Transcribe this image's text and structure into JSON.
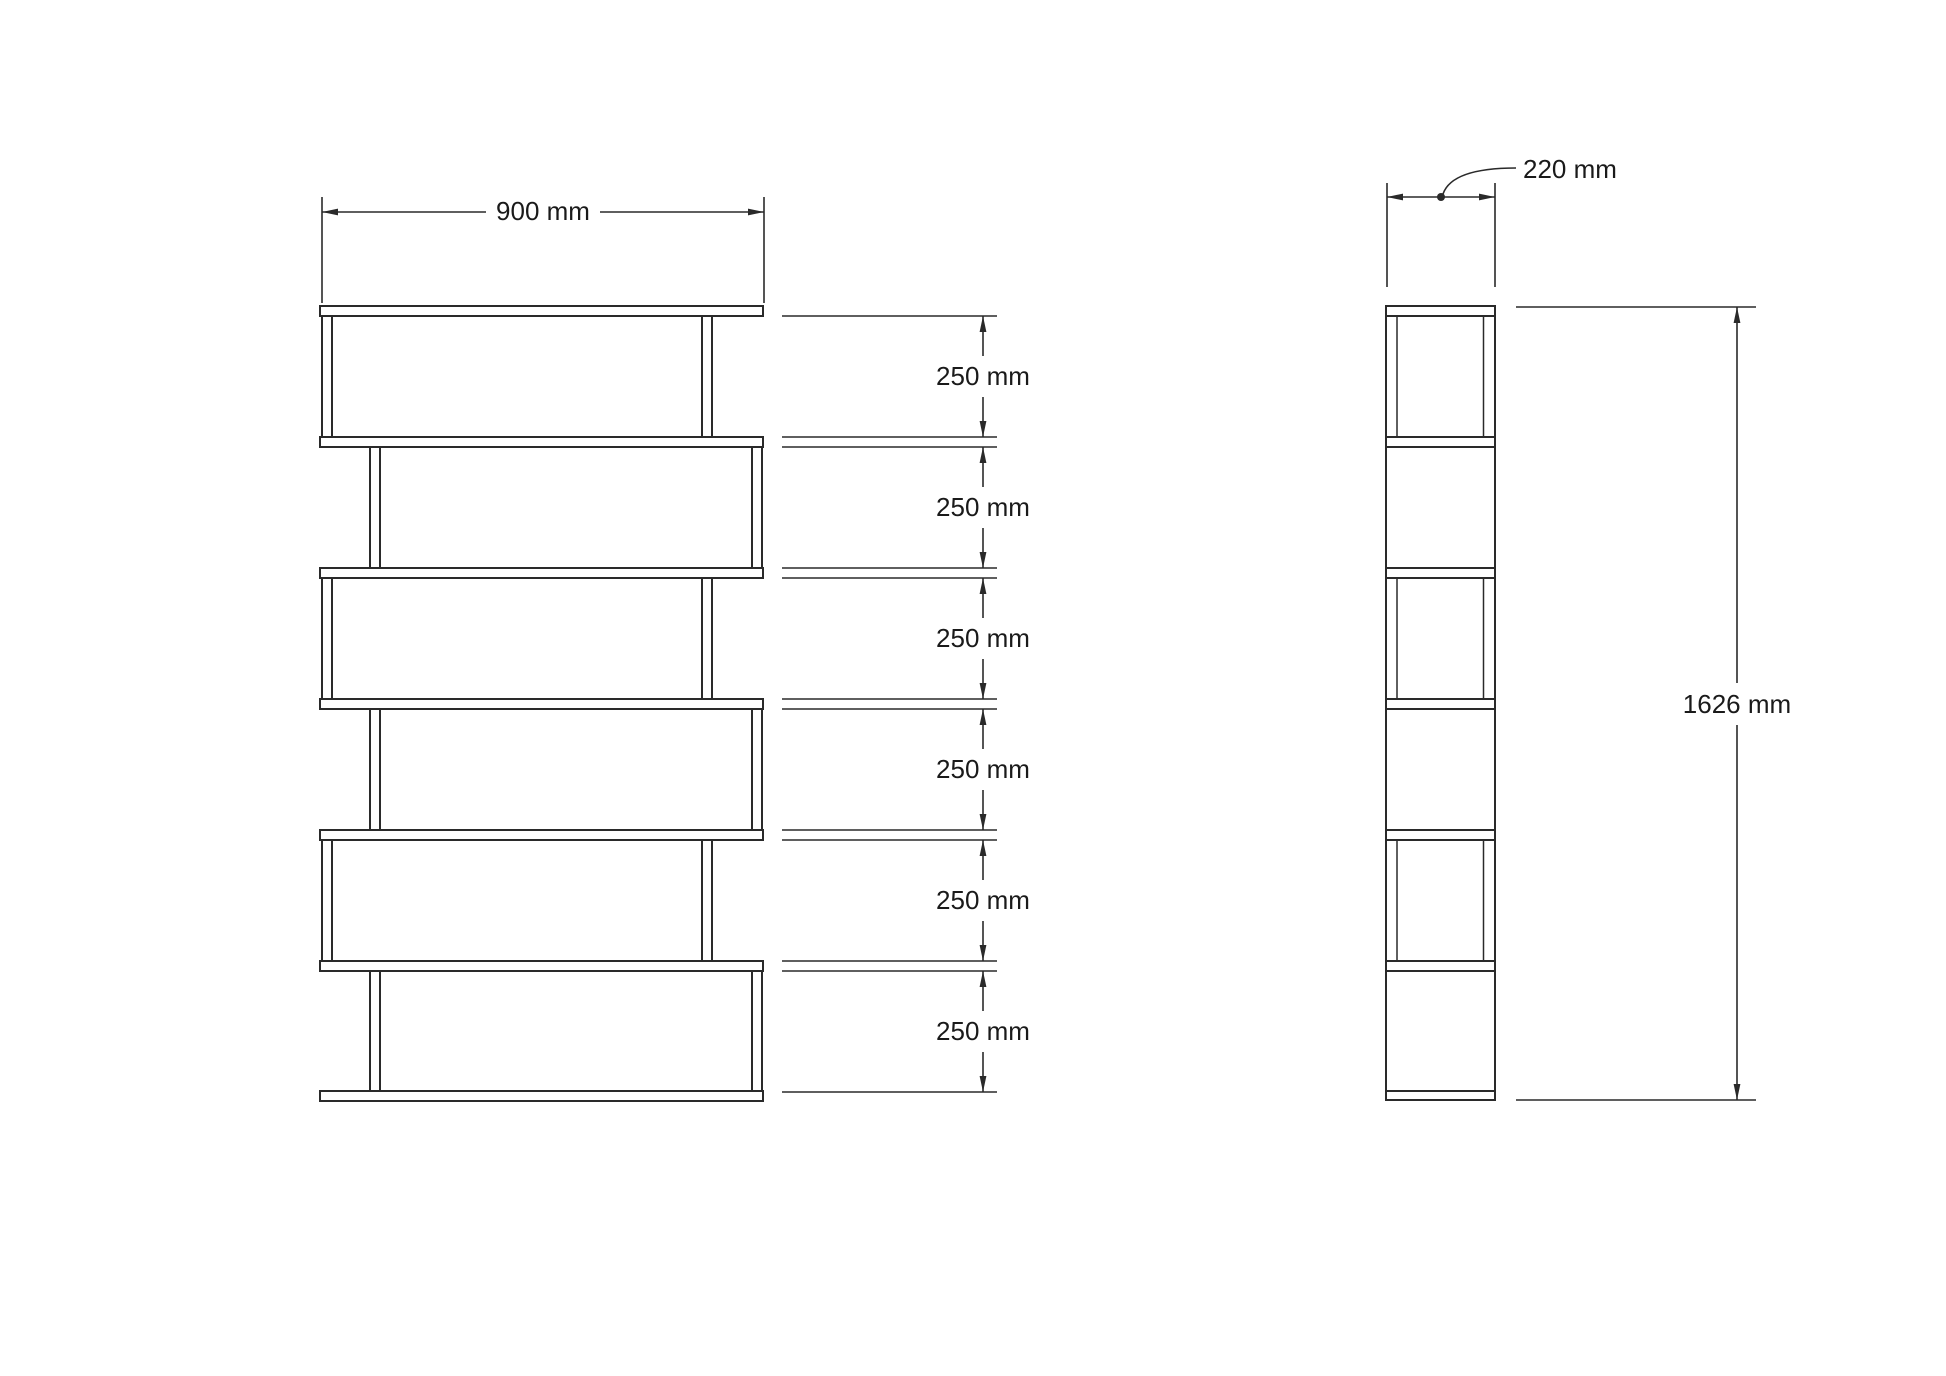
{
  "colors": {
    "line": "#2a2a2a",
    "text": "#1a1a1a",
    "background": "#ffffff"
  },
  "front_view": {
    "width_label": "900 mm",
    "compartment_labels": [
      "250 mm",
      "250 mm",
      "250 mm",
      "250 mm",
      "250 mm",
      "250 mm"
    ]
  },
  "side_view": {
    "depth_label": "220 mm",
    "height_label": "1626 mm"
  }
}
